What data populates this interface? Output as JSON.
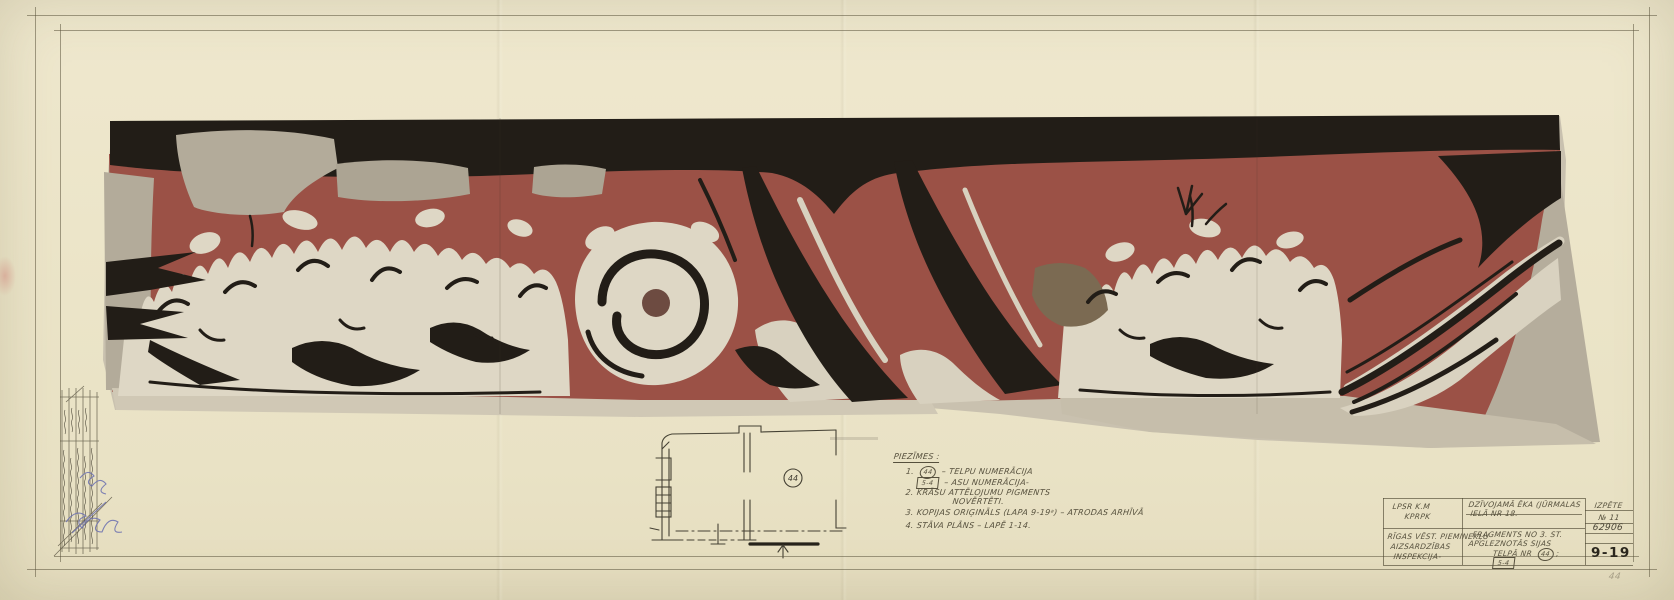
{
  "colors": {
    "frieze_red": "#9b5146",
    "ink_black": "#221d17",
    "plaster_cream": "#ded7c5",
    "plaster_gray": "#b3ab9a",
    "paper": "#ece5c9",
    "pencil": "#56503d",
    "blue_ink": "#6a6fb0"
  },
  "legend": {
    "heading": "PIEZĪMES :",
    "n1": "1.",
    "sym_room": "44",
    "t1": "–  TELPU NUMERĀCIJA",
    "sym_axis": "5-4",
    "t1b": "–  ASU NUMERĀCIJA-",
    "n2": "2.",
    "t2": "KRĀSU ATTĒLOJUMU PIGMENTS",
    "t2b": "NOVĒRTĒTI.",
    "n3": "3.",
    "t3": "KOPIJAS ORIĢINĀLS (LAPA 9-19ᵃ) – ATRODAS ARHĪVĀ",
    "n4": "4.",
    "t4": "STĀVA PLĀNS – LAPĒ 1-14."
  },
  "floor_plan": {
    "room": "44"
  },
  "title_block": {
    "org1a": "LPSR  K.M",
    "org1b": "KPRPK",
    "org2a": "RĪGAS VĒST. PIEMINEKĻU",
    "org2b": "AIZSARDZĪBAS",
    "org2c": "INSPEKCIJA-",
    "proj1": "DZĪVOJAMĀ ĒKA (JŪRMALAS",
    "proj2": "IELĀ NR 18.",
    "subj1": "FRAGMENTS NO 3. ST.",
    "subj2": "APGLEZNOTĀS SIJAS",
    "subj3": "TELPĀ NR",
    "subj_room": "44",
    "subj_end": ";",
    "subj_axis": "5-4",
    "col_header": "IZPĒTE",
    "col_no": "№ 11",
    "col_inv": "62906",
    "sheet_no": "9-19"
  },
  "margin": {
    "corner_number": "44"
  }
}
